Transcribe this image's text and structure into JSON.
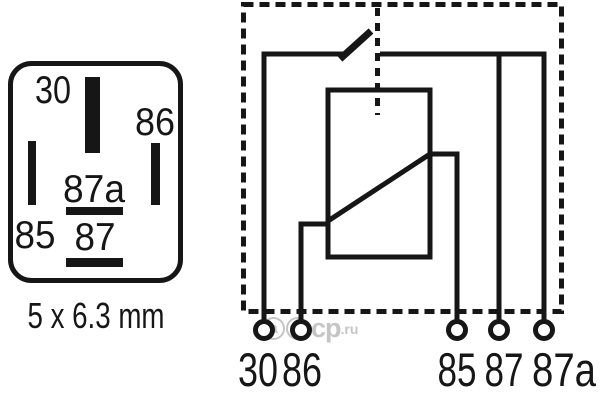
{
  "colors": {
    "ink": "#161616",
    "background": "#ffffff",
    "watermark_gray": "#c5c5c5"
  },
  "connector_view": {
    "pin_labels": {
      "p30": "30",
      "p86": "86",
      "p87a": "87a",
      "p85": "85",
      "p87": "87"
    },
    "blade_size_label": "5 x 6.3 mm"
  },
  "schematic_view": {
    "terminal_labels": {
      "t30": "30",
      "t86": "86",
      "t85": "85",
      "t87": "87",
      "t87a": "87a"
    }
  },
  "watermark": {
    "circled_letters": [
      "a",
      "b"
    ],
    "plain_letters": "cp",
    "suffix": ".ru"
  }
}
